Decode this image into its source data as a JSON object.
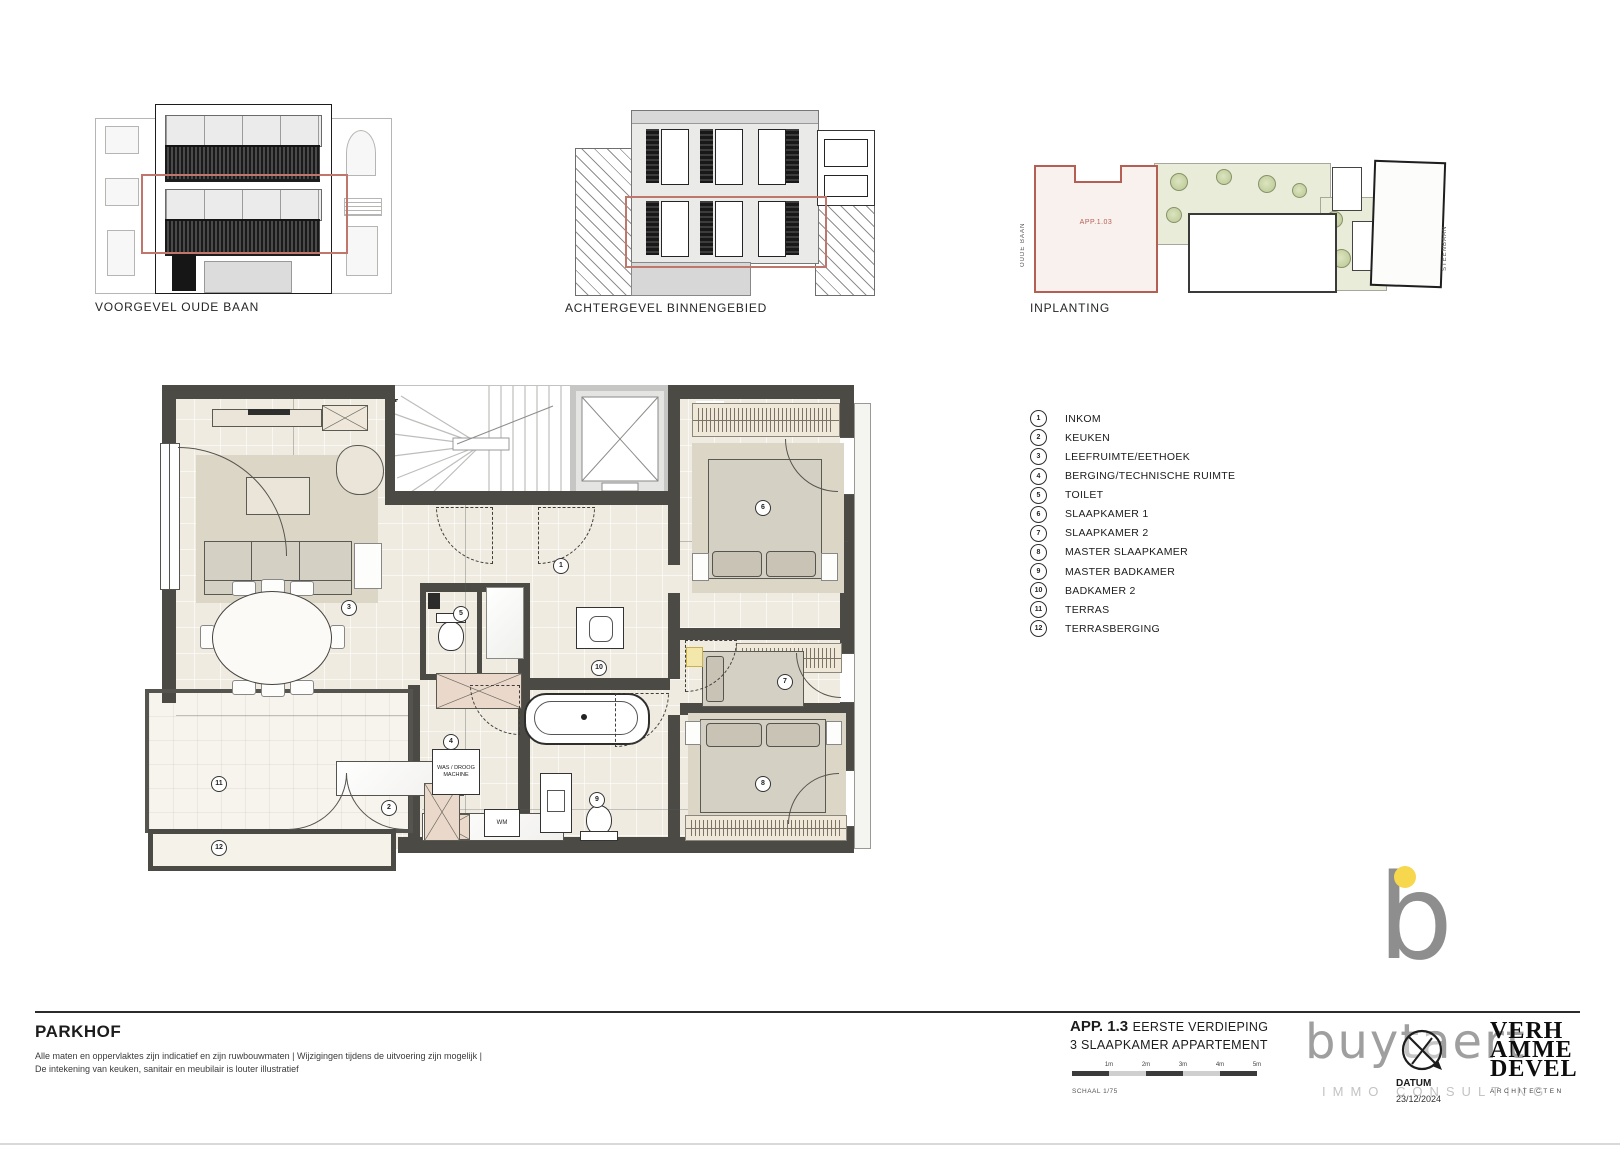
{
  "doc": {
    "project": "PARKHOF",
    "disclaimer_line1": "Alle maten en oppervlaktes zijn indicatief en zijn ruwbouwmaten | Wijzigingen tijdens de uitvoering zijn mogelijk |",
    "disclaimer_line2": "De intekening van keuken, sanitair en meubilair is louter illustratief",
    "apartment_code": "APP. 1.3",
    "floor_label": "EERSTE VERDIEPING",
    "apartment_type": "3 SLAAPKAMER APPARTEMENT",
    "scale_label": "SCHAAL 1/75",
    "scale_ticks": [
      "1m",
      "2m",
      "3m",
      "4m",
      "5m"
    ],
    "datum_label": "DATUM",
    "datum_value": "23/12/2024"
  },
  "sections": {
    "front_elevation_label": "VOORGEVEL OUDE BAAN",
    "rear_elevation_label": "ACHTERGEVEL BINNENGEBIED",
    "siteplan_label": "INPLANTING"
  },
  "siteplan": {
    "unit_label": "APP.1.03",
    "street_left": "OUDE BAAN",
    "street_right": "STEENBAAN"
  },
  "plan": {
    "washer_label": "WAS / DROOG MACHINE",
    "wm_label": "WM"
  },
  "legend": {
    "items": [
      {
        "num": "1",
        "label": "INKOM"
      },
      {
        "num": "2",
        "label": "KEUKEN"
      },
      {
        "num": "3",
        "label": "LEEFRUIMTE/EETHOEK"
      },
      {
        "num": "4",
        "label": "BERGING/TECHNISCHE RUIMTE"
      },
      {
        "num": "5",
        "label": "TOILET"
      },
      {
        "num": "6",
        "label": "SLAAPKAMER 1"
      },
      {
        "num": "7",
        "label": "SLAAPKAMER 2"
      },
      {
        "num": "8",
        "label": "MASTER SLAAPKAMER"
      },
      {
        "num": "9",
        "label": "MASTER BADKAMER"
      },
      {
        "num": "10",
        "label": "BADKAMER 2"
      },
      {
        "num": "11",
        "label": "TERRAS"
      },
      {
        "num": "12",
        "label": "TERRASBERGING"
      }
    ]
  },
  "logos": {
    "buytaert_mark": "b",
    "buytaert_wordmark": "buytaert",
    "buytaert_sub": "IMMO CONSULTING",
    "architect_line1": "VERH",
    "architect_line2": "AMME",
    "architect_line3": "DEVEL",
    "architect_sub": "ARCHITECTEN"
  },
  "colors": {
    "accent_red": "#b55f54",
    "wall_dark": "#4b4a45",
    "logo_gray": "#8e8e8e",
    "logo_yellow": "#f6d74e"
  }
}
